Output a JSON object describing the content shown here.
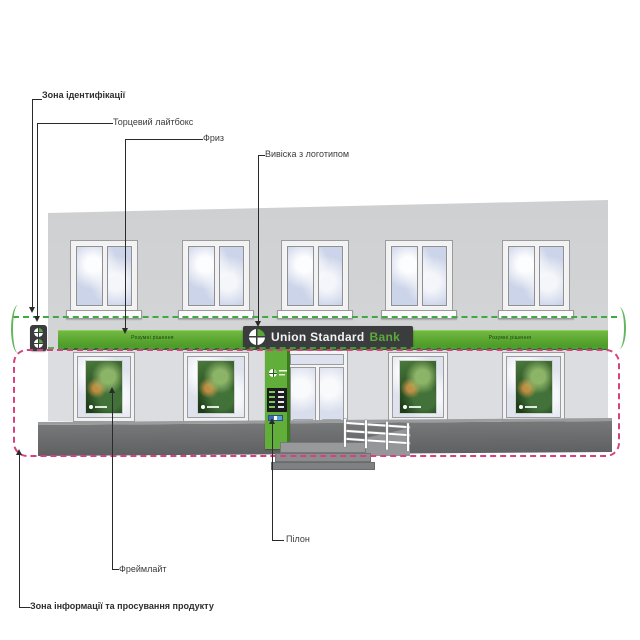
{
  "annotations": {
    "identification_zone": "Зона ідентифікації",
    "end_lightbox": "Торцевий лайтбокс",
    "frieze": "Фриз",
    "sign_with_logo": "Вивіска з логотипом",
    "pylon": "Пілон",
    "framelight": "Фреймлайт",
    "info_zone": "Зона інформації та просування продукту"
  },
  "signage": {
    "brand_name": "Union Standard",
    "brand_accent": "Bank",
    "frieze_slogan_left": "Розумні рішення",
    "frieze_slogan_right": "Розумні рішення"
  },
  "icons": {
    "brand_logo": "clover-logo"
  },
  "colors": {
    "brand_green": "#58a63a",
    "frieze_green": "#57a52e",
    "sign_dark": "#3b3c3e",
    "identification_zone_dashed": "#41a943",
    "info_zone_dashed": "#d6417f",
    "facade_gray": "#d2d3d5",
    "plinth_gray": "#67686a"
  }
}
